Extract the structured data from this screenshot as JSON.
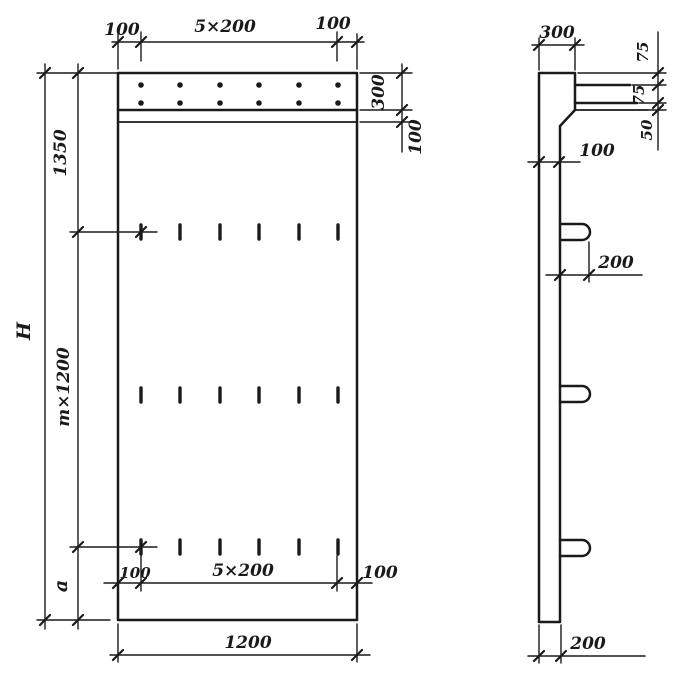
{
  "style": {
    "ink": "#1a1a1a",
    "paper": "#ffffff"
  },
  "front_view": {
    "dims": {
      "top_left": "100",
      "top_span": "5×200",
      "top_right": "100",
      "band_height": "300",
      "band_offset": "100",
      "left_upper": "1350",
      "left_middle": "m×1200",
      "left_total": "H",
      "left_lower": "a",
      "bottom_left": "100",
      "bottom_span": "5×200",
      "bottom_right": "100",
      "overall_width": "1200"
    }
  },
  "side_view": {
    "dims": {
      "top_thickness": "300",
      "bar_offset_top": "75",
      "bar_spacing": "75",
      "bar_offset_bottom": "50",
      "rib_thickness": "100",
      "loop_projection": "200",
      "bottom_thickness": "200"
    }
  }
}
